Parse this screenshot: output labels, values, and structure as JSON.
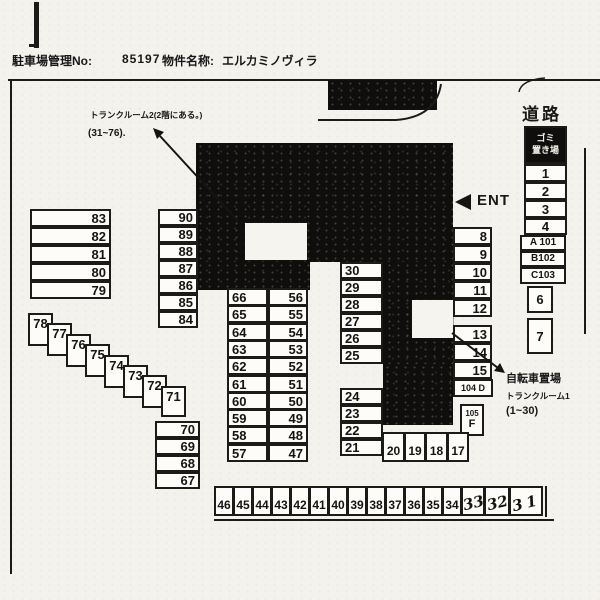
{
  "header": {
    "mgmt_label": "駐車場管理No:",
    "mgmt_number": "85197",
    "property_label": "物件名称:",
    "property_name": "エルカミノヴィラ"
  },
  "labels": {
    "road": "道路",
    "ent": "ENT",
    "garbage_line1": "ゴミ",
    "garbage_line2": "置き場"
  },
  "notes": {
    "trunkroom2_line1": "トランクルーム2(2階にある。)",
    "trunkroom2_line2": "(31~76).",
    "bicycle_line1": "自転車置場",
    "bicycle_line2": "トランクルーム1",
    "bicycle_line3": "(1~30)"
  },
  "lots": {
    "left_col": [
      "83",
      "82",
      "81",
      "80",
      "79"
    ],
    "col_90": [
      "90",
      "89",
      "88",
      "87",
      "86",
      "85",
      "84"
    ],
    "stairs": [
      "78",
      "77",
      "76",
      "75",
      "74",
      "73",
      "72",
      "71"
    ],
    "col_70": [
      "70",
      "69",
      "68",
      "67"
    ],
    "center_left": [
      "66",
      "65",
      "64",
      "63",
      "62",
      "61",
      "60",
      "59",
      "58",
      "57"
    ],
    "center_right": [
      "56",
      "55",
      "54",
      "53",
      "52",
      "51",
      "50",
      "49",
      "48",
      "47"
    ],
    "col_30": [
      "30",
      "29",
      "28",
      "27",
      "26",
      "25"
    ],
    "col_24": [
      "24",
      "23",
      "22",
      "21"
    ],
    "row_20": [
      "20",
      "19",
      "18",
      "17"
    ],
    "bottom_row": [
      "46",
      "45",
      "44",
      "43",
      "42",
      "41",
      "40",
      "39",
      "38",
      "37",
      "36",
      "35",
      "34"
    ],
    "bottom_row_hand": [
      "33",
      "32",
      "31"
    ],
    "right_nums": [
      "1",
      "2",
      "3",
      "4"
    ],
    "right_units": [
      "A 101",
      "B102",
      "C103"
    ],
    "box6": "6",
    "box7": "7",
    "col_8": [
      "8",
      "9",
      "10",
      "11",
      "12"
    ],
    "col_13": [
      "13",
      "14",
      "15"
    ],
    "unit_d": "104 D",
    "unit_f_top": "105",
    "unit_f_bottom": "F"
  }
}
